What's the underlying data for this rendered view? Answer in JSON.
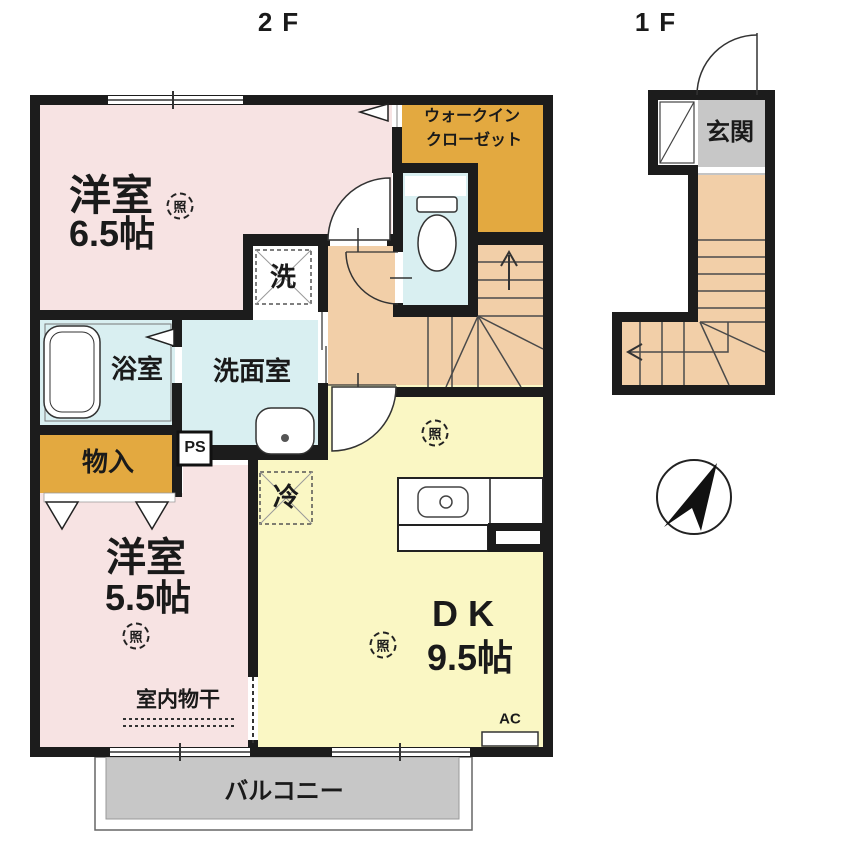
{
  "floors": {
    "second": "2F",
    "first": "1F"
  },
  "rooms": {
    "bedroom_65": {
      "name": "洋室",
      "size": "6.5帖"
    },
    "walk_in_closet": {
      "line1": "ウォークイン",
      "line2": "クローゼット"
    },
    "bathroom": "浴室",
    "washroom": "洗面室",
    "storage": "物入",
    "bedroom_55": {
      "name": "洋室",
      "size": "5.5帖"
    },
    "dining_kitchen": {
      "name": "DK",
      "size": "9.5帖"
    },
    "balcony": "バルコニー",
    "entrance": "玄関"
  },
  "fixtures": {
    "washing_machine": "洗",
    "refrigerator": "冷",
    "pipe_space": "PS",
    "air_conditioner": "AC",
    "indoor_drying": "室内物干",
    "ceiling_light": "照"
  },
  "colors": {
    "room_pink": "#f7e3e3",
    "room_yellow": "#faf7c4",
    "closet_orange": "#e3a940",
    "hall_peach": "#f2cfa8",
    "wet_area_cyan": "#d9eff1",
    "balcony_gray": "#c7c7c7",
    "wall_black": "#1c1c1c"
  }
}
